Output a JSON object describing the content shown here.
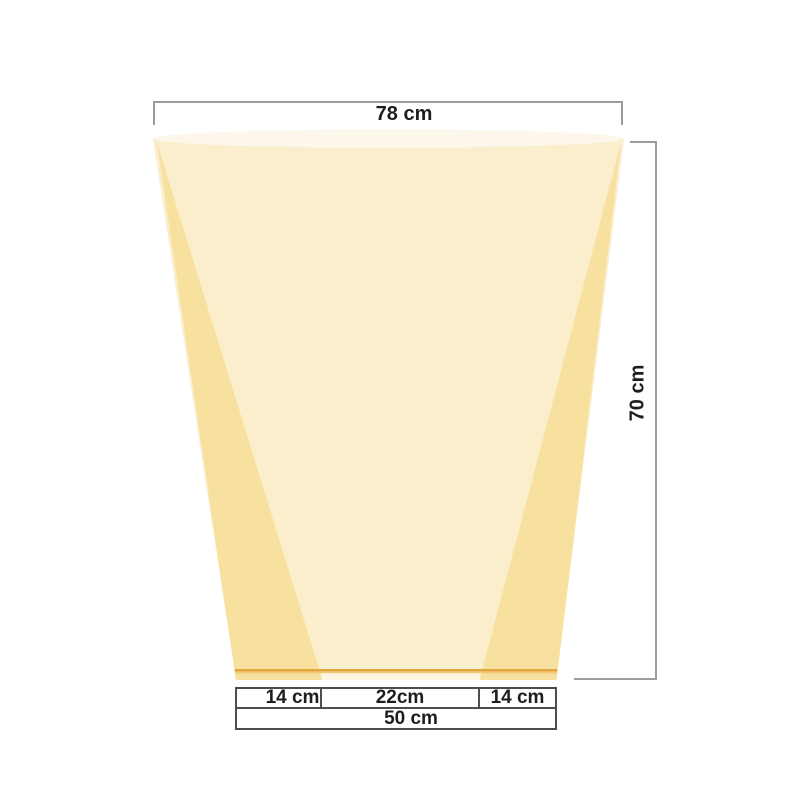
{
  "dimensions": {
    "top_width": "78 cm",
    "height": "70 cm",
    "bottom_segments": [
      "14 cm",
      "22cm",
      "14 cm"
    ],
    "bottom_total": "50 cm"
  },
  "colors": {
    "front_face": "#FAEECD",
    "side_panel": "#F8E09E",
    "top_surface": "#FCF7EA",
    "hem_inner": "#FDF6E3",
    "trim_dark": "#E3A53D",
    "trim_light": "#F1C979",
    "dim_line_light": "#9C9C9C",
    "dim_line_dark": "#4D4D4D",
    "label_text": "#1E1E1E"
  }
}
